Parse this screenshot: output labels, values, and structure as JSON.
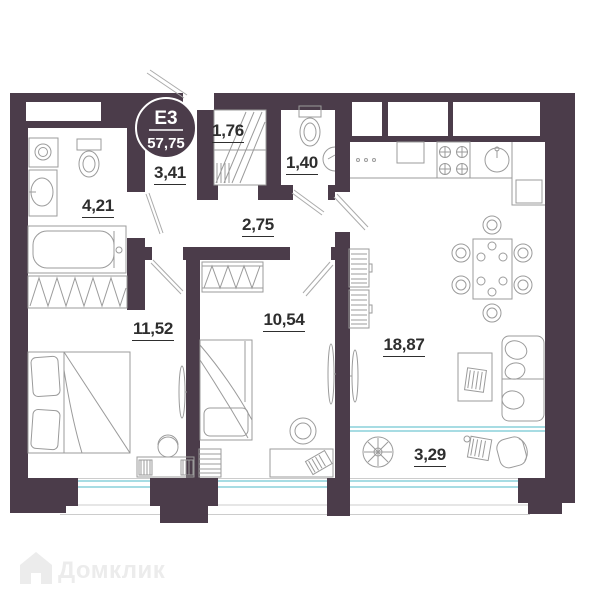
{
  "plan": {
    "badge": {
      "unit": "Е3",
      "area": "57,75"
    },
    "rooms": [
      {
        "name": "storage",
        "area": "1,76"
      },
      {
        "name": "hallway",
        "area": "3,41"
      },
      {
        "name": "wc",
        "area": "1,40"
      },
      {
        "name": "bathroom",
        "area": "4,21"
      },
      {
        "name": "corridor",
        "area": "2,75"
      },
      {
        "name": "bedroom-1",
        "area": "11,52"
      },
      {
        "name": "bedroom-2",
        "area": "10,54"
      },
      {
        "name": "living-kitchen",
        "area": "18,87"
      },
      {
        "name": "balcony",
        "area": "3,29"
      }
    ],
    "watermark": "Домклик",
    "colors": {
      "wall": "#4b3c4a",
      "window": "#a7dce3",
      "furniture": "#9b9b9b",
      "label": "#2e2e2e"
    }
  }
}
